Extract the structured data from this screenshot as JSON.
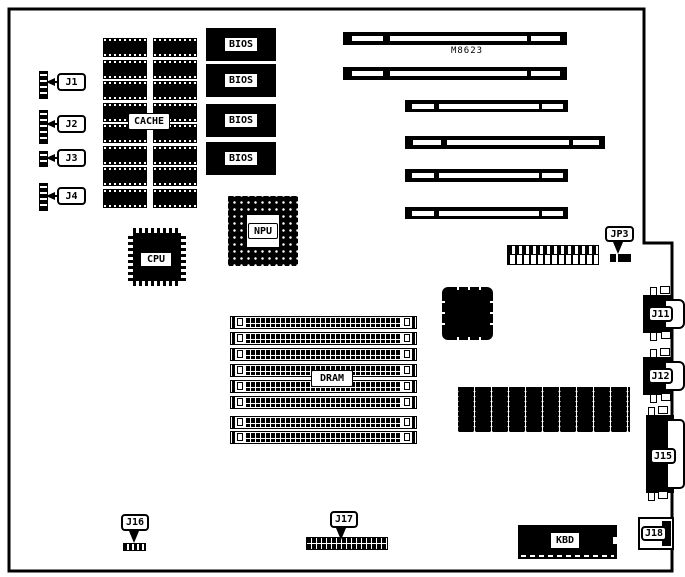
{
  "board": {
    "model": "M8623"
  },
  "labels": {
    "j1": "J1",
    "j2": "J2",
    "j3": "J3",
    "j4": "J4",
    "cache": "CACHE",
    "bios": [
      "BIOS",
      "BIOS",
      "BIOS",
      "BIOS"
    ],
    "cpu": "CPU",
    "npu": "NPU",
    "jp3": "JP3",
    "dram": "DRAM",
    "j11": "J11",
    "j12": "J12",
    "j15": "J15",
    "j16": "J16",
    "j17": "J17",
    "j18": "J18",
    "kbd": "KBD"
  },
  "colors": {
    "ink": "#000000",
    "paper": "#ffffff"
  }
}
